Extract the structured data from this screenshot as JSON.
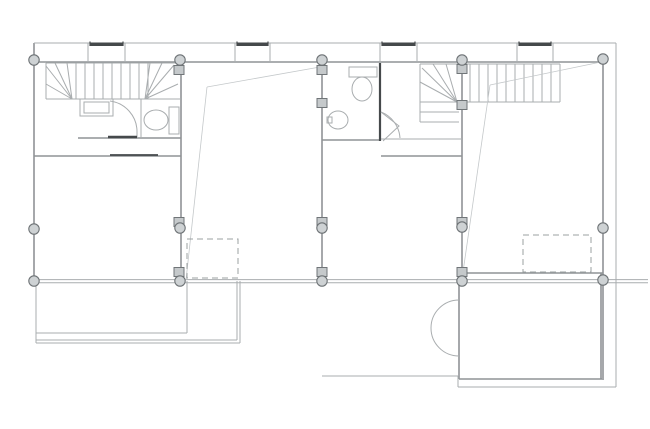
{
  "meta": {
    "title": "architectural-floor-plan",
    "drawing_type": "upper floor plan, four-unit row house"
  },
  "canvas": {
    "width": 650,
    "height": 429,
    "background": "#ffffff"
  },
  "colors": {
    "wall": "#8f9396",
    "thin": "#a9adaf",
    "dark": "#45494b",
    "sight": "#c4c8ca",
    "dashed": "#9ba0a2",
    "column_fill": "#ced2d4",
    "column_stroke": "#6e7376",
    "post_fill": "#c5c9cb",
    "post_stroke": "#707578",
    "fixture": "#a9adaf"
  },
  "plan": {
    "walls": [
      [
        34,
        43,
        34,
        281,
        "left-exterior-wall"
      ],
      [
        34,
        62,
        606,
        62,
        "top-facade-wall"
      ],
      [
        181,
        62,
        181,
        281,
        "party-wall-1"
      ],
      [
        322,
        62,
        322,
        281,
        "party-wall-2"
      ],
      [
        462,
        62,
        462,
        281,
        "party-wall-3"
      ],
      [
        603,
        62,
        603,
        380,
        "right-exterior-wall"
      ],
      [
        459,
        273,
        603,
        273,
        "unit4-rear-wall"
      ],
      [
        34,
        156,
        181,
        156,
        "unit1-mid-wall"
      ],
      [
        78,
        138,
        181,
        138,
        "unit1-bath-wall"
      ],
      [
        322,
        140,
        381,
        140,
        "unit3-bath-wall"
      ],
      [
        381,
        156,
        462,
        156,
        "unit3-mid-wall"
      ],
      [
        459,
        379,
        602,
        379,
        "entry-room-bottom-wall"
      ],
      [
        459,
        273,
        459,
        379,
        "entry-room-left-wall"
      ],
      [
        601,
        273,
        601,
        379,
        "entry-room-right-wall"
      ]
    ],
    "thin_lines": [
      [
        34,
        43,
        616,
        43,
        "roof-edge-top"
      ],
      [
        616,
        43,
        616,
        387,
        "roof-edge-right"
      ],
      [
        458,
        387,
        616,
        387,
        "roof-edge-bottom"
      ],
      [
        458,
        376,
        458,
        387,
        "lower-step-joint"
      ],
      [
        322,
        376,
        458,
        376,
        "lower-terrace-edge"
      ],
      [
        34,
        279.6,
        648,
        279.6,
        "rear-facade-line-a"
      ],
      [
        34,
        282.8,
        648,
        282.8,
        "rear-facade-line-b"
      ],
      [
        46,
        63,
        178,
        63,
        "stair1-top-edge"
      ],
      [
        46,
        63,
        46,
        99,
        "stair1-left-edge"
      ],
      [
        46,
        99,
        181,
        99,
        "stair1-bottom-edge"
      ],
      [
        76,
        63,
        76,
        99,
        "stair1-tread"
      ],
      [
        85,
        63,
        85,
        99,
        "stair1-tread"
      ],
      [
        94,
        63,
        94,
        99,
        "stair1-tread"
      ],
      [
        103,
        63,
        103,
        99,
        "stair1-tread"
      ],
      [
        112,
        63,
        112,
        99,
        "stair1-tread"
      ],
      [
        121,
        63,
        121,
        99,
        "stair1-tread"
      ],
      [
        130,
        63,
        130,
        99,
        "stair1-tread"
      ],
      [
        139,
        63,
        139,
        99,
        "stair1-tread"
      ],
      [
        148,
        63,
        148,
        99,
        "stair1-tread"
      ],
      [
        72,
        99,
        46,
        66,
        "stair1-winder"
      ],
      [
        72,
        99,
        55,
        63,
        "stair1-winder"
      ],
      [
        72,
        99,
        67,
        63,
        "stair1-winder"
      ],
      [
        72,
        99,
        46,
        84,
        "stair1-winder"
      ],
      [
        145,
        99,
        150,
        63,
        "stair1-winder"
      ],
      [
        145,
        99,
        162,
        63,
        "stair1-winder"
      ],
      [
        145,
        99,
        174,
        65,
        "stair1-winder"
      ],
      [
        145,
        99,
        178,
        84,
        "stair1-winder"
      ],
      [
        141,
        99,
        141,
        138,
        "unit1-wc-wall"
      ],
      [
        420,
        64,
        560,
        64,
        "stair2-top-edge"
      ],
      [
        420,
        64,
        420,
        122,
        "stair2-left-edge"
      ],
      [
        560,
        64,
        560,
        102,
        "stair2-right-edge"
      ],
      [
        420,
        102,
        560,
        102,
        "stair2-bottom-edge"
      ],
      [
        470,
        64,
        470,
        102,
        "stair2-tread"
      ],
      [
        479,
        64,
        479,
        102,
        "stair2-tread"
      ],
      [
        488,
        64,
        488,
        102,
        "stair2-tread"
      ],
      [
        497,
        64,
        497,
        102,
        "stair2-tread"
      ],
      [
        506,
        64,
        506,
        102,
        "stair2-tread"
      ],
      [
        515,
        64,
        515,
        102,
        "stair2-tread"
      ],
      [
        524,
        64,
        524,
        102,
        "stair2-tread"
      ],
      [
        533,
        64,
        533,
        102,
        "stair2-tread"
      ],
      [
        542,
        64,
        542,
        102,
        "stair2-tread"
      ],
      [
        551,
        64,
        551,
        102,
        "stair2-tread"
      ],
      [
        457,
        102,
        446,
        64,
        "stair2-winder"
      ],
      [
        457,
        102,
        433,
        64,
        "stair2-winder"
      ],
      [
        457,
        102,
        422,
        68,
        "stair2-winder"
      ],
      [
        457,
        102,
        420,
        82,
        "stair2-winder"
      ],
      [
        420,
        112,
        459,
        112,
        "stair2-landing-step"
      ],
      [
        420,
        122,
        459,
        122,
        "stair2-landing-step"
      ],
      [
        381,
        139,
        462,
        139,
        "unit3-hall-line"
      ],
      [
        36,
        281,
        36,
        343,
        "terrace-left-edge"
      ],
      [
        36,
        343,
        240,
        343,
        "terrace-bottom-outer"
      ],
      [
        36,
        340,
        237,
        340,
        "terrace-bottom-inner"
      ],
      [
        240,
        281,
        240,
        343,
        "terrace-right-outer"
      ],
      [
        237,
        281,
        237,
        340,
        "terrace-right-inner"
      ],
      [
        36,
        333,
        187,
        333,
        "terrace-inner-line"
      ],
      [
        187,
        281,
        187,
        333,
        "terrace-inner-edge"
      ],
      [
        88,
        43,
        88,
        62,
        "window-box-side"
      ],
      [
        125,
        43,
        125,
        62,
        "window-box-side"
      ],
      [
        235,
        43,
        235,
        62,
        "window-box-side"
      ],
      [
        270,
        43,
        270,
        62,
        "window-box-side"
      ],
      [
        380,
        43,
        380,
        62,
        "window-box-side"
      ],
      [
        417,
        43,
        417,
        62,
        "window-box-side"
      ],
      [
        517,
        43,
        517,
        62,
        "window-box-side"
      ],
      [
        553,
        43,
        553,
        62,
        "window-box-side"
      ],
      [
        137,
        132,
        137,
        138,
        "unit1-door-leaf"
      ]
    ],
    "dark_lines": [
      {
        "x1": 108,
        "y1": 137,
        "x2": 137,
        "y2": 137,
        "w": 2.6,
        "n": "unit1-door-sill"
      },
      {
        "x1": 380,
        "y1": 63,
        "x2": 380,
        "y2": 141,
        "w": 2.2,
        "n": "unit3-bath-partition"
      },
      {
        "x1": 110,
        "y1": 155,
        "x2": 158,
        "y2": 155,
        "w": 1.8,
        "n": "unit1-sliding-door"
      },
      {
        "x1": 90,
        "y1": 41.5,
        "x2": 90,
        "y2": 46,
        "w": 1.2,
        "n": "window-bar-tick"
      },
      {
        "x1": 123,
        "y1": 41.5,
        "x2": 123,
        "y2": 46,
        "w": 1.2,
        "n": "window-bar-tick"
      },
      {
        "x1": 237,
        "y1": 41.5,
        "x2": 237,
        "y2": 46,
        "w": 1.2,
        "n": "window-bar-tick"
      },
      {
        "x1": 268,
        "y1": 41.5,
        "x2": 268,
        "y2": 46,
        "w": 1.2,
        "n": "window-bar-tick"
      },
      {
        "x1": 382,
        "y1": 41.5,
        "x2": 382,
        "y2": 46,
        "w": 1.2,
        "n": "window-bar-tick"
      },
      {
        "x1": 415,
        "y1": 41.5,
        "x2": 415,
        "y2": 46,
        "w": 1.2,
        "n": "window-bar-tick"
      },
      {
        "x1": 519,
        "y1": 41.5,
        "x2": 519,
        "y2": 46,
        "w": 1.2,
        "n": "window-bar-tick"
      },
      {
        "x1": 551,
        "y1": 41.5,
        "x2": 551,
        "y2": 46,
        "w": 1.2,
        "n": "window-bar-tick"
      }
    ],
    "window_bars": [
      [
        90,
        42.5,
        33,
        3.5
      ],
      [
        237,
        42.5,
        31,
        3.5
      ],
      [
        382,
        42.5,
        33,
        3.5
      ],
      [
        519,
        42.5,
        32,
        3.5
      ]
    ],
    "sight_lines": [
      [
        320,
        67,
        207,
        87,
        "unit2-void-line"
      ],
      [
        207,
        87,
        186,
        280,
        "unit2-void-line"
      ],
      [
        601,
        62,
        490,
        85,
        "unit4-void-line"
      ],
      [
        490,
        85,
        463,
        272,
        "unit4-void-line"
      ]
    ],
    "dashed_rects": [
      {
        "x": 187,
        "y": 239,
        "w": 51,
        "h": 39,
        "n": "unit2-skylight-dashed"
      },
      {
        "x": 523,
        "y": 235,
        "w": 68,
        "h": 37,
        "n": "unit4-skylight-dashed"
      }
    ],
    "columns": [
      [
        34,
        60
      ],
      [
        180,
        60
      ],
      [
        322,
        60
      ],
      [
        462,
        60
      ],
      [
        603,
        59
      ],
      [
        34,
        229
      ],
      [
        180,
        228
      ],
      [
        322,
        228
      ],
      [
        462,
        227
      ],
      [
        603,
        228
      ],
      [
        34,
        281
      ],
      [
        180,
        281
      ],
      [
        322,
        281
      ],
      [
        462,
        281
      ],
      [
        603,
        280
      ]
    ],
    "posts": [
      [
        179,
        70
      ],
      [
        322,
        70
      ],
      [
        462,
        69
      ],
      [
        322,
        103
      ],
      [
        462,
        105
      ],
      [
        179,
        222
      ],
      [
        322,
        222
      ],
      [
        462,
        222
      ],
      [
        179,
        272
      ],
      [
        322,
        272
      ],
      [
        462,
        272
      ]
    ],
    "fixture_rects": [
      {
        "x": 80,
        "y": 99,
        "w": 33,
        "h": 17,
        "n": "unit1-washbasin-outer"
      },
      {
        "x": 84,
        "y": 102,
        "w": 25,
        "h": 11,
        "n": "unit1-washbasin-inner"
      },
      {
        "x": 169,
        "y": 107,
        "w": 10,
        "h": 27,
        "n": "unit1-toilet-tank"
      },
      {
        "x": 349,
        "y": 67,
        "w": 28,
        "h": 10,
        "n": "unit3-toilet-tank"
      },
      {
        "x": 327,
        "y": 117,
        "w": 5,
        "h": 6,
        "n": "unit3-sink-tap"
      }
    ],
    "fixture_ellipses": [
      {
        "cx": 156,
        "cy": 120,
        "rx": 12,
        "ry": 10,
        "n": "unit1-toilet-bowl"
      },
      {
        "cx": 362,
        "cy": 89,
        "rx": 10,
        "ry": 12,
        "n": "unit3-toilet-bowl"
      },
      {
        "cx": 338,
        "cy": 120,
        "rx": 10,
        "ry": 9,
        "n": "unit3-sink-basin"
      }
    ],
    "arcs": [
      {
        "d": "M 459 300 A 28 28 0 0 0 459 356",
        "n": "entry-door-swing"
      },
      {
        "d": "M 110 101 A 31 31 0 0 1 137 132",
        "n": "unit1-door-swing"
      },
      {
        "d": "M 381 112 A 30 30 0 0 1 400 138",
        "n": "unit3-door-swing"
      },
      {
        "d": "M 381 112 L 399 126 L 383 141",
        "n": "unit3-door-leaf"
      }
    ]
  }
}
